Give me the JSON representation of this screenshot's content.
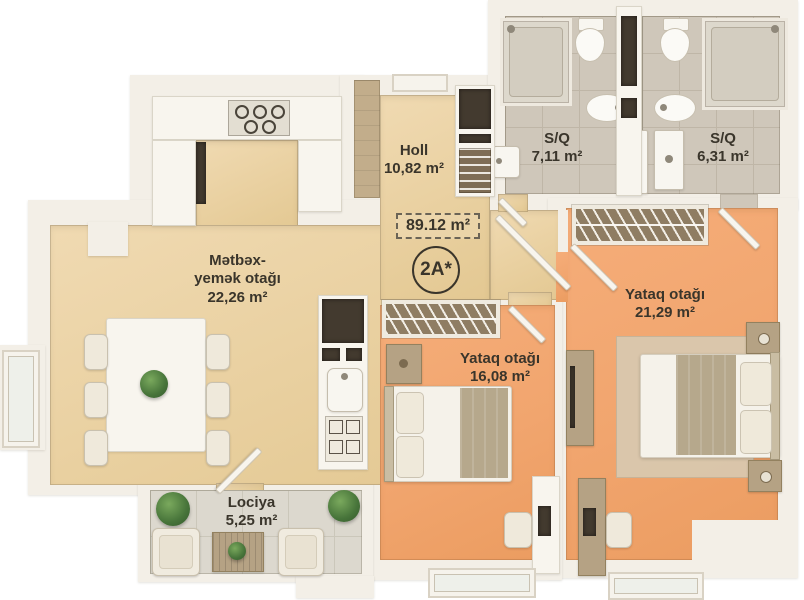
{
  "badge": {
    "total_area": "89.12 m²",
    "unit_code": "2A*"
  },
  "rooms": {
    "hall": {
      "name": "Holl",
      "area": "10,82 m²"
    },
    "kitchen_dining": {
      "name_line1": "Mətbəx-",
      "name_line2": "yemək otağı",
      "area": "22,26 m²"
    },
    "bathroom_left": {
      "name": "S/Q",
      "area": "7,11 m²"
    },
    "bathroom_right": {
      "name": "S/Q",
      "area": "6,31 m²"
    },
    "bedroom_large": {
      "name": "Yataq otağı",
      "area": "21,29 m²"
    },
    "bedroom_small": {
      "name": "Yataq otağı",
      "area": "16,08 m²"
    },
    "loggia": {
      "name": "Lociya",
      "area": "5,25 m²"
    }
  },
  "colors": {
    "wall": "#f3efe7",
    "floor_beige": "#ecd5a9",
    "floor_orange": "#f2a873",
    "bath_tile": "#cfc7ba",
    "loggia_tile": "#dcd8ce",
    "wood": "#b5a284",
    "wardrobe_interior": "#8f7d63",
    "text": "#3a352b",
    "plant_green": "#4e7d3c",
    "dark_fixture": "#433a2f"
  }
}
